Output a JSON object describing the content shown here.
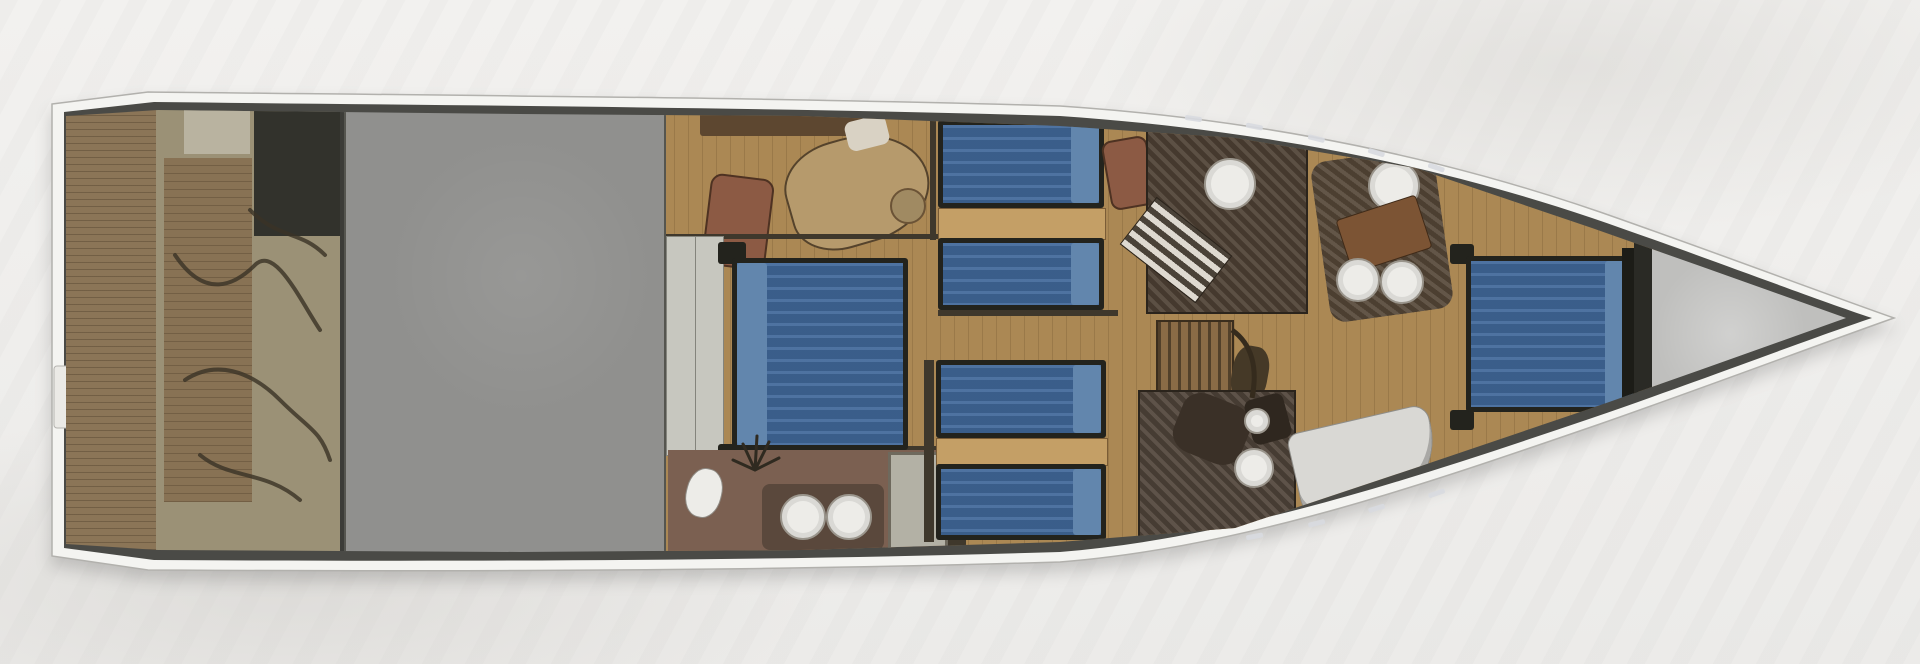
{
  "meta": {
    "subject": "yacht-lower-deck-floor-plan-top-view",
    "orientation": "bow-right-stern-left"
  },
  "palette": {
    "hull_outer": "#f4f4f1",
    "hull_stroke": "#b2b1ad",
    "hull_band": "#4a4a46",
    "notch_white": "#ebeae6",
    "teak": "#8b7557",
    "beach_floor": "#9b9176",
    "beach_teak": "#887254",
    "beach_dark_block": "#32322c",
    "beach_light_patch": "#b9b3a0",
    "engine_room": "#90908e",
    "wood": "#ab8854",
    "wardrobe": "#c7c7bf",
    "wall_dark": "#3f382c",
    "bed_frame": "#23231d",
    "bed_blue": "#41689a",
    "pillow_blue": "#6286ad",
    "nightstand": "#c49f66",
    "cabinet_brown": "#5d4730",
    "chaise_tan": "#b69a6c",
    "pillow_cream": "#d9d2c4",
    "chair_red": "#8c5a44",
    "stool_tan": "#a08a62",
    "tile_mauve": "#7b6051",
    "tile_dark": "#4e4134",
    "tile_dark2": "#50443a",
    "fixture_white": "#edece8",
    "counter_dark": "#5a483c",
    "shower_glass": "#b3b1a5",
    "stairs_wood": "#8a6b46",
    "stair_side": "#453927",
    "dark_fixture": "#3a3027",
    "dark_fixture2": "#2f271f",
    "vanity_floor": "#564838",
    "desk_brown": "#7c5434",
    "sofa_white": "#d9d8d4",
    "headboard": "#1c1c17",
    "bulkhead": "#2a2a25",
    "forepeak": "#bfbfbd",
    "window_dash": "#d8dbe0",
    "rope_dark": "#3a3326",
    "plant_dark": "#2f2a20",
    "railing_dark": "#352b1d"
  },
  "areas": [
    {
      "name": "swim-platform"
    },
    {
      "name": "beach-club-garage"
    },
    {
      "name": "engine-room"
    },
    {
      "name": "lounge-office"
    },
    {
      "name": "vip-cabin"
    },
    {
      "name": "vip-bathroom"
    },
    {
      "name": "twin-cabin-port"
    },
    {
      "name": "twin-cabin-starboard"
    },
    {
      "name": "bathroom-port"
    },
    {
      "name": "bathroom-starboard"
    },
    {
      "name": "staircase"
    },
    {
      "name": "master-vanity"
    },
    {
      "name": "master-cabin"
    },
    {
      "name": "forepeak"
    }
  ]
}
